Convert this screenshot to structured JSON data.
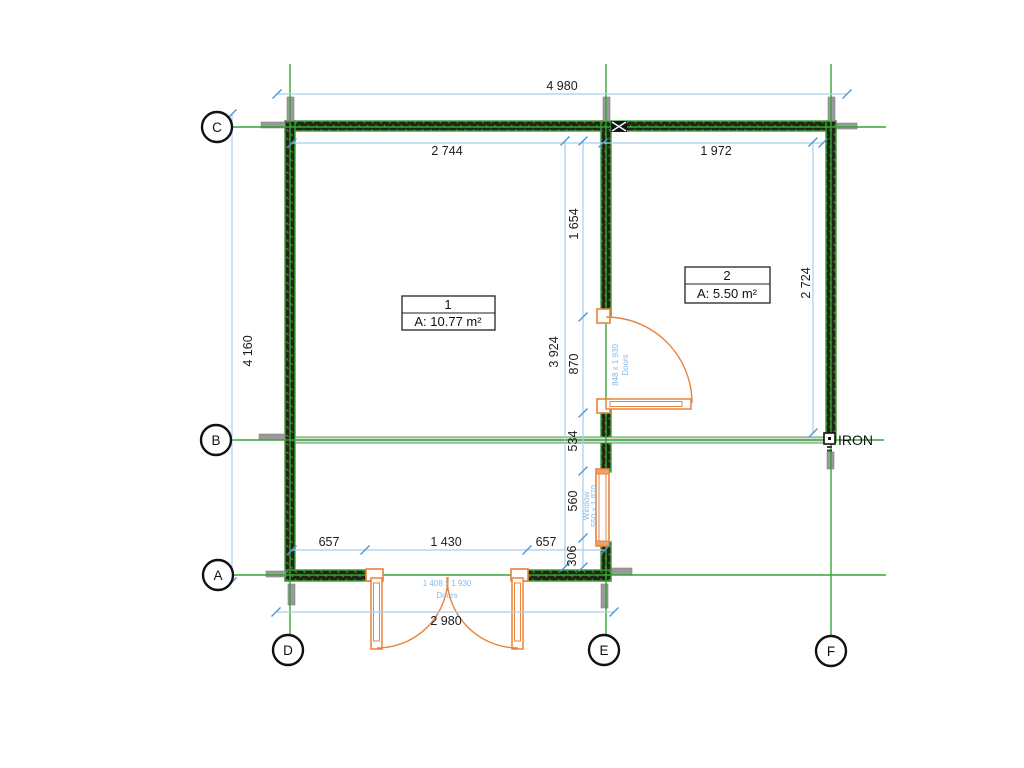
{
  "plan": {
    "rooms": [
      {
        "number": "1",
        "area": "A: 10.77 m²"
      },
      {
        "number": "2",
        "area": "A: 5.50 m²"
      }
    ],
    "grid_labels": {
      "left": [
        "C",
        "B",
        "A"
      ],
      "bottom": [
        "D",
        "E",
        "F"
      ]
    },
    "dimensions": {
      "overall_width": "4 980",
      "room1_width": "2 744",
      "room2_width": "1 972",
      "overall_height_left": "4 160",
      "room1_height": "3 924",
      "room2_height": "2 724",
      "seg_1654": "1 654",
      "seg_870": "870",
      "seg_534": "534",
      "seg_560": "560",
      "seg_306": "306",
      "bottom_657_left": "657",
      "bottom_1430": "1 430",
      "bottom_657_right": "657",
      "bottom_2980": "2 980"
    },
    "openings": {
      "interior_door": {
        "size": "848 x 1 930",
        "type": "Doors"
      },
      "window": {
        "size": "550 x 1 870",
        "type": "Window"
      },
      "entrance_door": {
        "size": "1 408 x 1 930",
        "type": "Doors"
      }
    },
    "annotations": {
      "iron": "IRON"
    },
    "colors": {
      "grid_green": "#36a336",
      "wall_dark": "#1e2715",
      "dim_line_blue": "#a9cdec",
      "tick_blue": "#4f97d9",
      "label_blue": "#85b9e8",
      "opening_orange": "#e8823d",
      "stub_gray": "#9a9a9a"
    }
  }
}
